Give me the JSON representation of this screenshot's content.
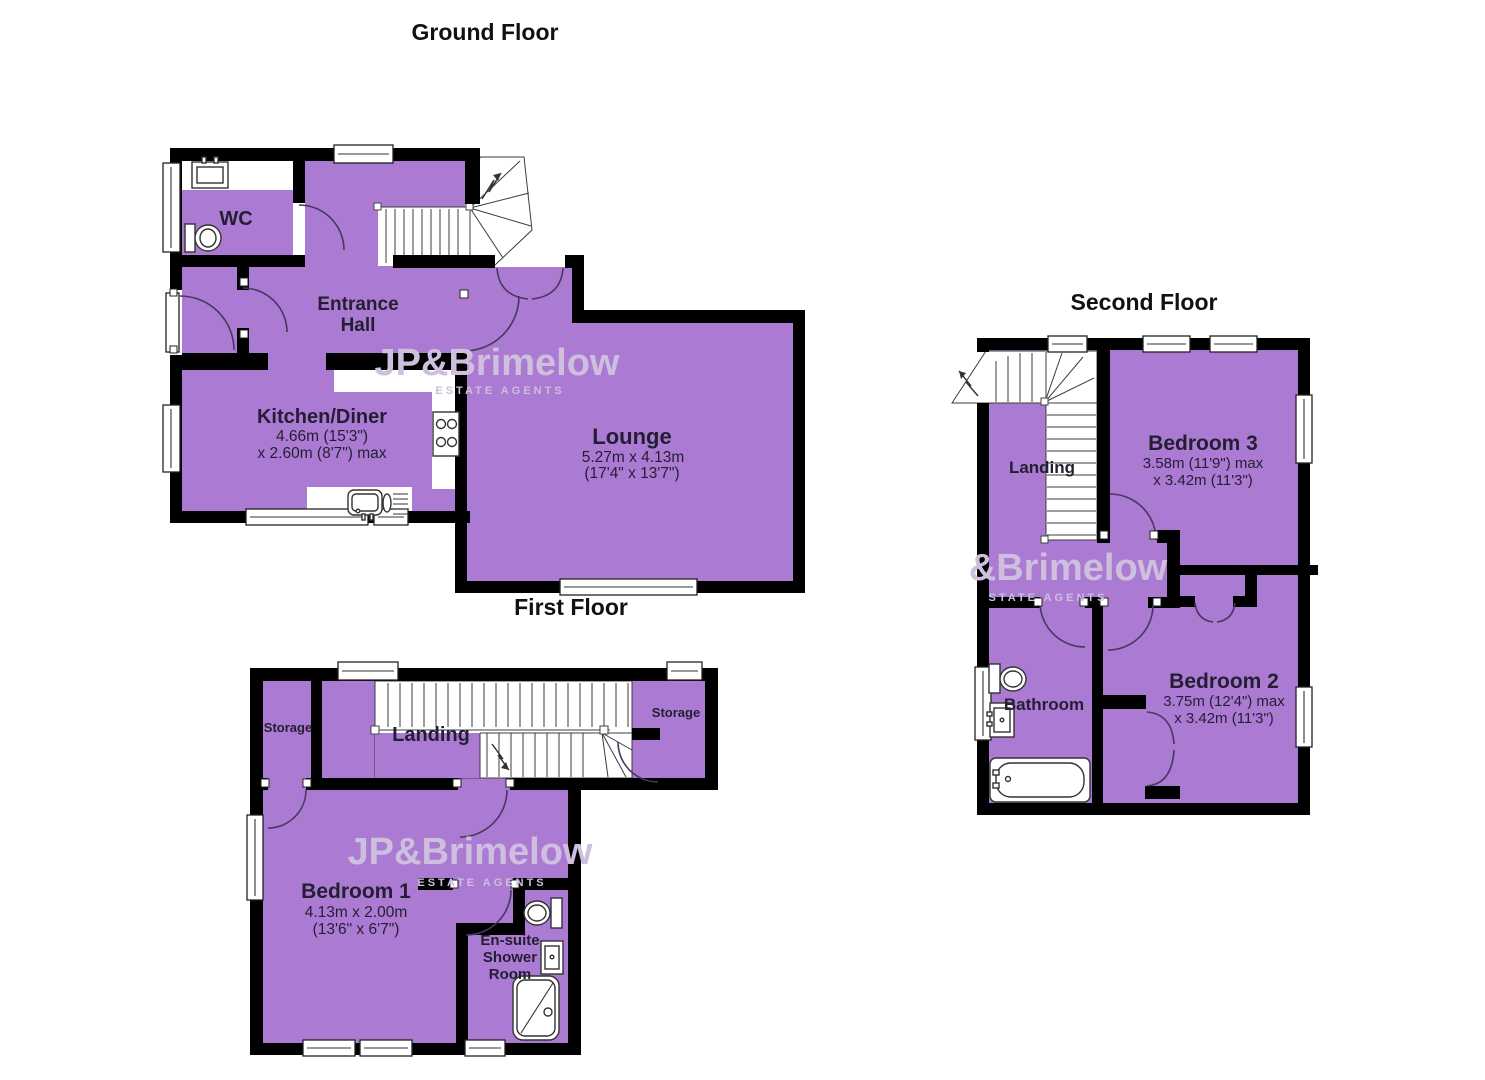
{
  "colors": {
    "room_fill": "#ab7ad2",
    "wall": "#000000",
    "door_arc": "#46395f",
    "watermark": "#cdbfdd",
    "label": "#241e33"
  },
  "titles": {
    "ground": "Ground Floor",
    "first": "First Floor",
    "second": "Second Floor"
  },
  "watermark": {
    "brand": "JP&Brimelow",
    "brand_partial": "&Brimelow",
    "tagline": "ESTATE AGENTS",
    "tagline_partial": "STATE AGENTS"
  },
  "ground": {
    "wc": {
      "name": "WC"
    },
    "hall": {
      "line1": "Entrance",
      "line2": "Hall"
    },
    "kitchen": {
      "name": "Kitchen/Diner",
      "dim1": "4.66m (15'3\")",
      "dim2": "x 2.60m (8'7\") max"
    },
    "lounge": {
      "name": "Lounge",
      "dim1": "5.27m x 4.13m",
      "dim2": "(17'4\" x 13'7\")"
    }
  },
  "first": {
    "storage_left": {
      "name": "Storage"
    },
    "landing": {
      "name": "Landing"
    },
    "storage_right": {
      "name": "Storage"
    },
    "bedroom1": {
      "name": "Bedroom 1",
      "dim1": "4.13m x 2.00m",
      "dim2": "(13'6\" x 6'7\")"
    },
    "ensuite": {
      "line1": "En-suite",
      "line2": "Shower",
      "line3": "Room"
    }
  },
  "second": {
    "landing": {
      "name": "Landing"
    },
    "bedroom3": {
      "name": "Bedroom 3",
      "dim1": "3.58m (11'9\") max",
      "dim2": "x 3.42m (11'3\")"
    },
    "bathroom": {
      "name": "Bathroom"
    },
    "bedroom2": {
      "name": "Bedroom 2",
      "dim1": "3.75m (12'4\") max",
      "dim2": "x 3.42m (11'3\")"
    }
  }
}
